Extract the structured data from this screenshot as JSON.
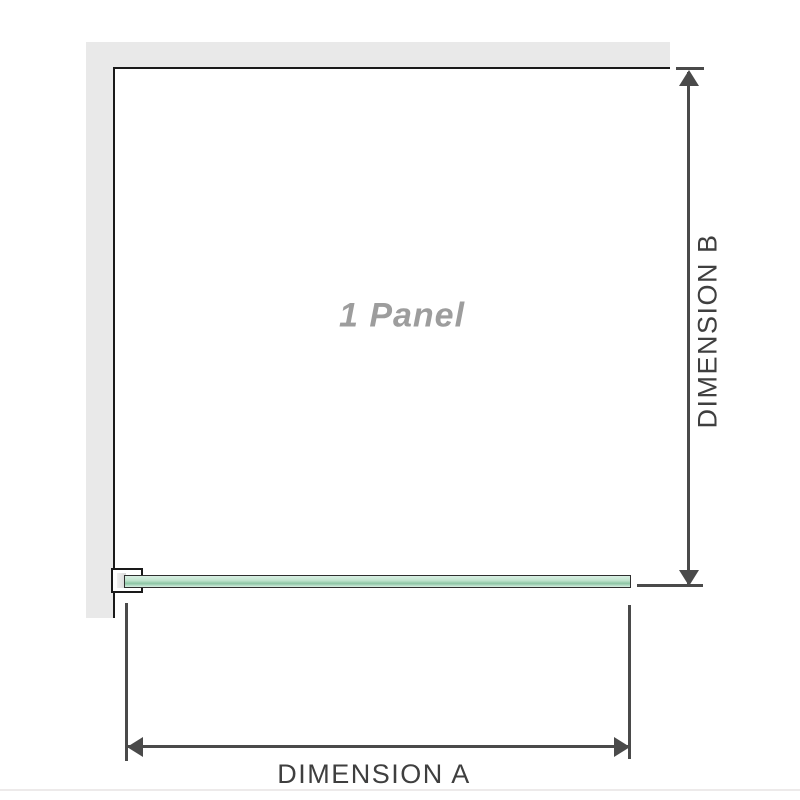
{
  "diagram": {
    "panel_label": "1 Panel",
    "dimension_a_label": "DIMENSION A",
    "dimension_b_label": "DIMENSION B"
  },
  "colors": {
    "wall": "#e9e9e9",
    "outline": "#1a1a1a",
    "dimension": "#4a4a4a",
    "label_text": "#3f3f3f",
    "panel_label_text": "#9d9d9d",
    "glass_light": "#d9efe3",
    "glass_mid": "#bfe3cd",
    "glass_dark": "#8cc5a4",
    "bracket_fill": "#ffffff",
    "bracket_inner": "#d8d8d8"
  }
}
